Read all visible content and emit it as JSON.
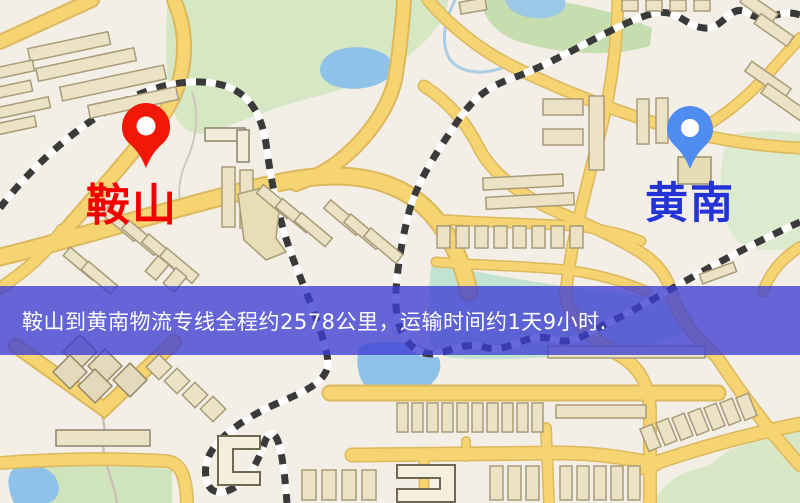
{
  "pins": {
    "origin": {
      "label": "鞍山",
      "color": "#f21807",
      "label_color": "#f40000"
    },
    "destination": {
      "label": "黄南",
      "color": "#4f8cf0",
      "label_color": "#2333d6"
    }
  },
  "banner": {
    "text": "鞍山到黄南物流专线全程约2578公里，运输时间约1天9小时.",
    "background": "#4b4bd2",
    "text_color": "#ffffff"
  },
  "map_palette": {
    "background": "#f4efe6",
    "road_fill": "#f7d472",
    "road_casing": "#dcb85e",
    "water": "#8fc2e8",
    "park": "#d5e7c3",
    "building": "#ece3c6",
    "railway": "#3a3a3a"
  }
}
